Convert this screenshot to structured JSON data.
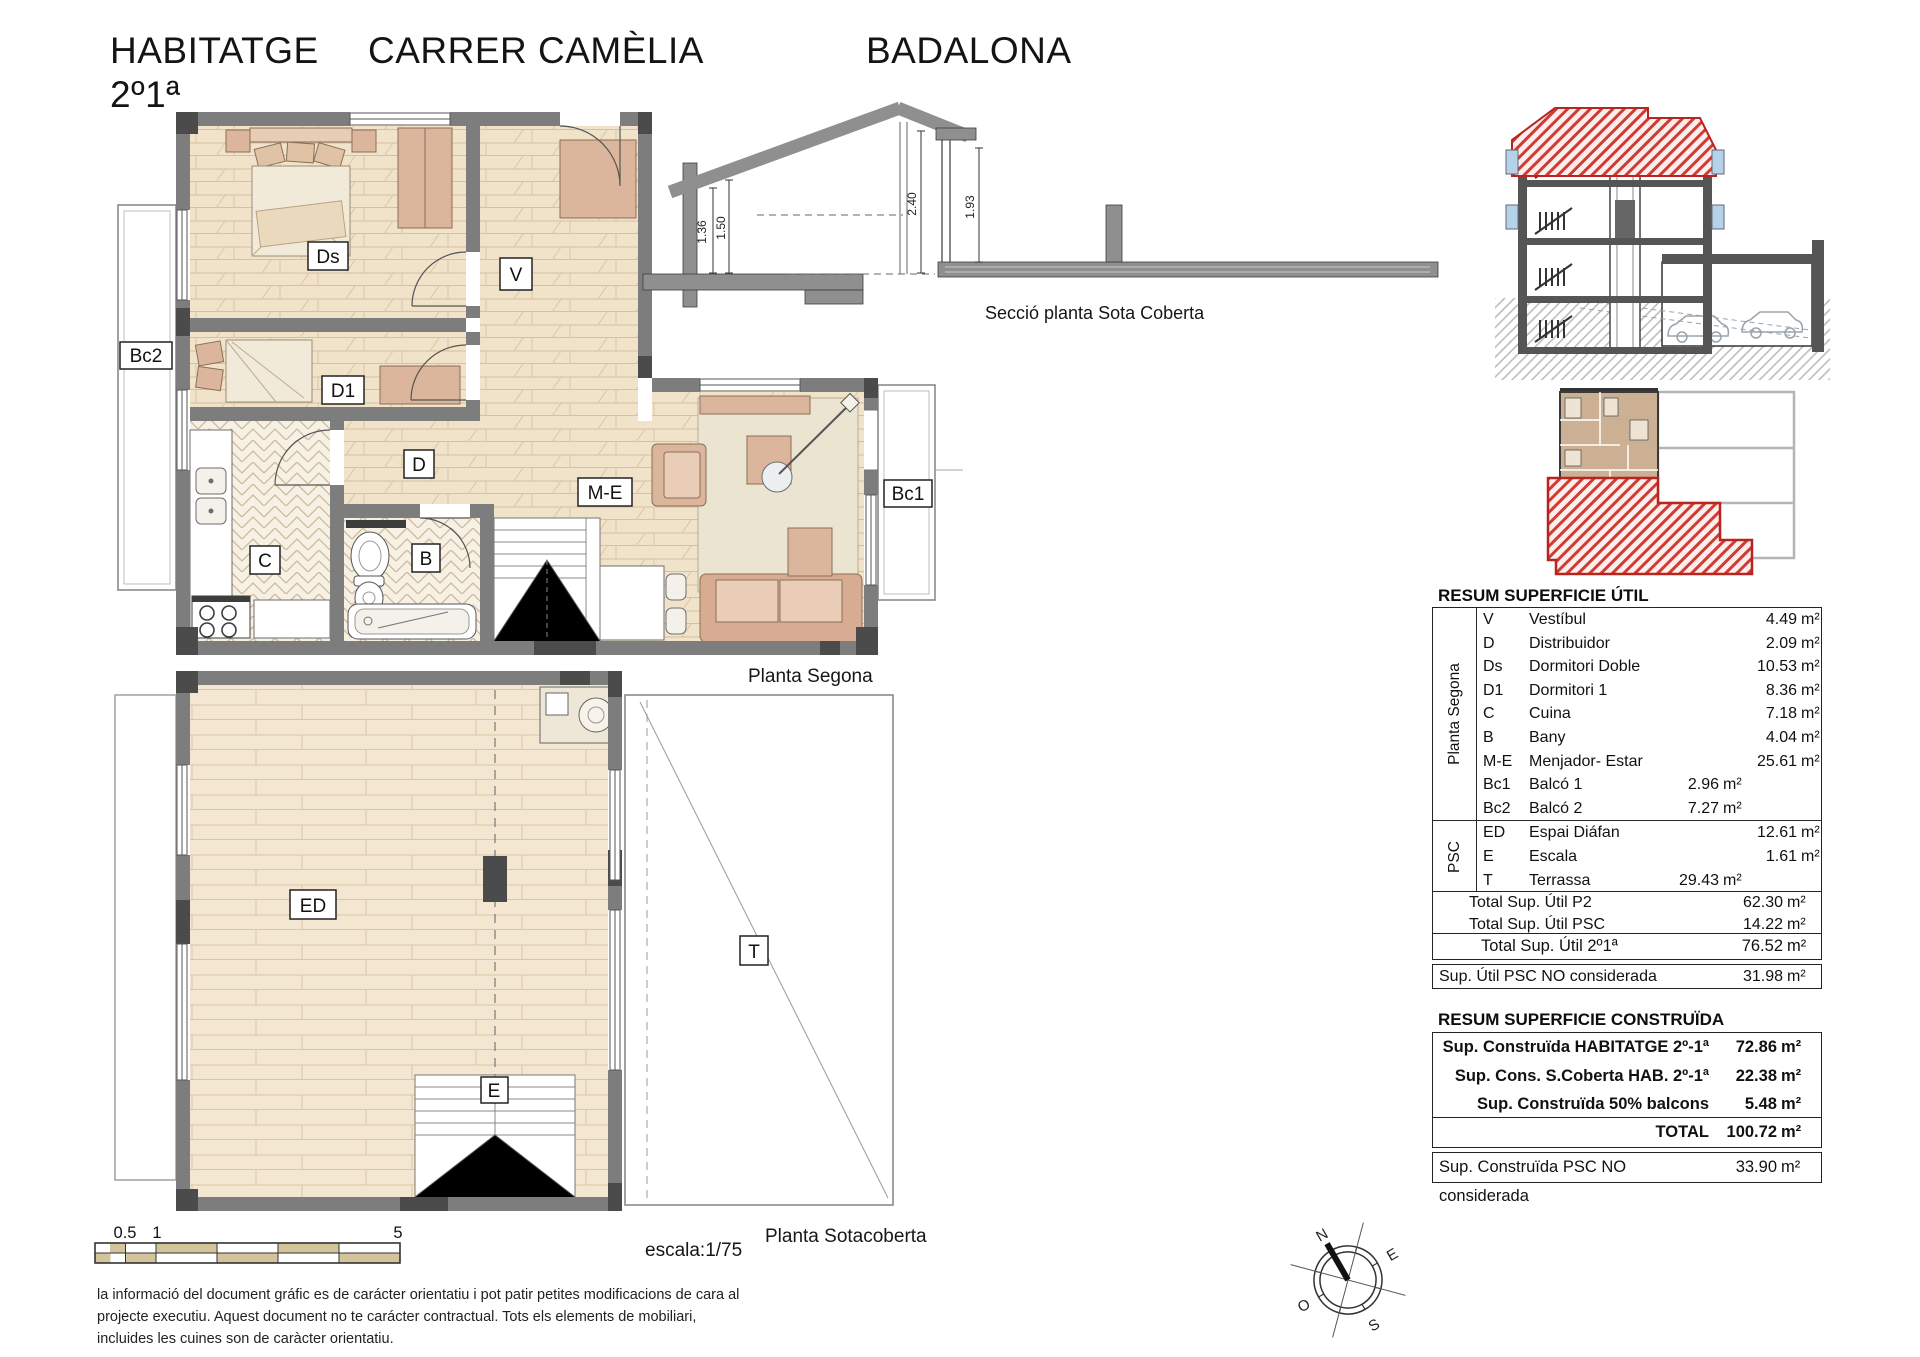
{
  "title": {
    "part1": "HABITATGE",
    "part2": "CARRER CAMÈLIA",
    "part3": "BADALONA",
    "line2": "2º1ª"
  },
  "captions": {
    "planta_segona": "Planta Segona",
    "planta_sotacoberta": "Planta Sotacoberta",
    "seccio": "Secció planta Sota Coberta",
    "escala": "escala:1/75"
  },
  "rooms": {
    "ds": "Ds",
    "d1": "D1",
    "v": "V",
    "d": "D",
    "c": "C",
    "b": "B",
    "me": "M-E",
    "bc1": "Bc1",
    "bc2": "Bc2",
    "ed": "ED",
    "e": "E",
    "t": "T"
  },
  "section_dims": {
    "d1": "1.36",
    "d2": "1.50",
    "d3": "2.40",
    "d4": "1.93"
  },
  "compass": {
    "n": "N",
    "e": "E",
    "s": "S",
    "o": "O"
  },
  "scalebar": {
    "l1": "0.5",
    "l2": "1",
    "l3": "5"
  },
  "colors": {
    "accent_red": "#c0392b",
    "wall_gray": "#7d7d7d",
    "wood": "#f1e2ca",
    "window_blue": "#b5d2ea",
    "scale_tan": "#d3c49b"
  },
  "util": {
    "title": "RESUM SUPERFICIE ÚTIL",
    "groups": [
      {
        "label": "Planta Segona",
        "rows": [
          [
            "V",
            "Vestíbul",
            "",
            "",
            "4.49",
            "m²"
          ],
          [
            "D",
            "Distribuidor",
            "",
            "",
            "2.09",
            "m²"
          ],
          [
            "Ds",
            "Dormitori Doble",
            "",
            "",
            "10.53",
            "m²"
          ],
          [
            "D1",
            "Dormitori 1",
            "",
            "",
            "8.36",
            "m²"
          ],
          [
            "C",
            "Cuina",
            "",
            "",
            "7.18",
            "m²"
          ],
          [
            "B",
            "Bany",
            "",
            "",
            "4.04",
            "m²"
          ],
          [
            "M-E",
            "Menjador- Estar",
            "",
            "",
            "25.61",
            "m²"
          ],
          [
            "Bc1",
            "Balcó 1",
            "2.96",
            "m²",
            "",
            ""
          ],
          [
            "Bc2",
            "Balcó 2",
            "7.27",
            "m²",
            "",
            ""
          ]
        ]
      },
      {
        "label": "PSC",
        "rows": [
          [
            "ED",
            "Espai Diáfan",
            "",
            "",
            "12.61",
            "m²"
          ],
          [
            "E",
            "Escala",
            "",
            "",
            "1.61",
            "m²"
          ],
          [
            "T",
            "Terrassa",
            "29.43",
            "m²",
            "",
            ""
          ]
        ]
      }
    ],
    "totals": [
      [
        "Total Sup. Útil P2",
        "62.30",
        "m²"
      ],
      [
        "Total Sup. Útil PSC",
        "14.22",
        "m²"
      ]
    ],
    "grand": [
      "Total Sup. Útil 2º1ª",
      "76.52",
      "m²"
    ],
    "extra": [
      "Sup. Útil PSC NO considerada",
      "31.98",
      "m²"
    ]
  },
  "constr": {
    "title": "RESUM SUPERFICIE CONSTRUÏDA",
    "rows": [
      [
        "Sup. Construïda HABITATGE 2º-1ª",
        "72.86",
        "m²"
      ],
      [
        "Sup. Cons. S.Coberta HAB. 2º-1ª",
        "22.38",
        "m²"
      ],
      [
        "Sup. Construïda 50% balcons",
        "5.48",
        "m²"
      ]
    ],
    "total": [
      "TOTAL",
      "100.72",
      "m²"
    ],
    "extra": [
      "Sup. Construïda PSC NO considerada",
      "33.90",
      "m²"
    ]
  },
  "disclaimer": "la informació del document gráfic es de carácter orientatiu i pot patir petites modificacions de cara al projecte executiu. Aquest document no te carácter contractual. Tots els elements de mobiliari, incluides les cuines son de caràcter orientatiu."
}
